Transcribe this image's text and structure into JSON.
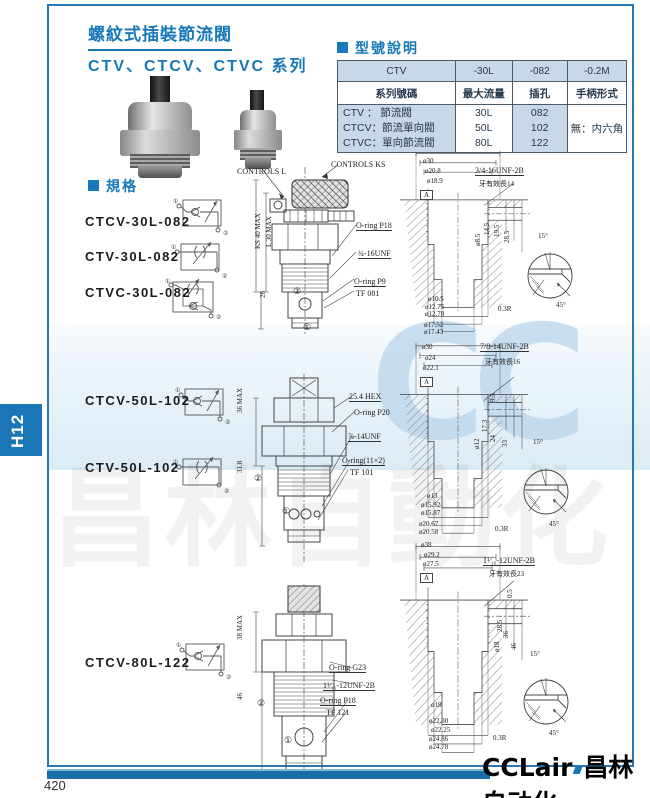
{
  "page": {
    "number": "420",
    "tab": "H12",
    "logo": "CCLair",
    "logo_cn": "昌林自动化"
  },
  "watermark": {
    "cc": "CC",
    "text": "昌林自動化"
  },
  "header": {
    "title": "螺紋式插裝節流閥",
    "subtitle": "CTV、CTCV、CTVC 系列"
  },
  "model_table": {
    "heading": "型號說明",
    "row1": [
      "CTV",
      "-30L",
      "-082",
      "-0.2M"
    ],
    "row2": [
      "系列號碼",
      "最大流量",
      "插孔",
      "手柄形式"
    ],
    "series": [
      "CTV ： 節流閥",
      "CTCV：節流單向閥",
      "CTVC：單向節流閥"
    ],
    "flows": [
      "30L",
      "50L",
      "80L"
    ],
    "holes": [
      "082",
      "102",
      "122"
    ],
    "handle": "無：内六角"
  },
  "spec": {
    "heading": "規格",
    "port1": "①",
    "port2": "②",
    "models": [
      "CTCV-30L-082",
      "CTV-30L-082",
      "CTVC-30L-082",
      "CTCV-50L-102",
      "CTV-50L-102",
      "CTCV-80L-122"
    ]
  },
  "drawings": [
    {
      "name": "30L",
      "valve": {
        "label_left": "CONTROLS L",
        "label_right": "CONTROLS KS",
        "dims": [
          "KS 40 MAX",
          "L 30 MAX",
          "28"
        ],
        "callouts": [
          "O-ring P18",
          "¾-16UNF",
          "O-ring P9",
          "TF 081"
        ],
        "ports": [
          "②",
          "①"
        ]
      },
      "cavity": {
        "top_dias": [
          "ø30",
          "ø20.8",
          "ø18.9"
        ],
        "datum": "A",
        "thread": "3/4-16UNF-2B",
        "thread_note": "牙有效長14",
        "depths": [
          "14.5",
          "19.5",
          "28.5"
        ],
        "port_dia": "ø8.5",
        "bottom_dias": [
          "ø10.5",
          "ø12.75",
          "ø12.70",
          "ø17.52",
          "ø17.43"
        ]
      },
      "detail": {
        "angle1": "15°",
        "radius": "0.3R",
        "angle2": "45°"
      }
    },
    {
      "name": "50L",
      "valve": {
        "dims": [
          "36 MAX",
          "31.8"
        ],
        "callouts": [
          "25.4 HEX",
          "O-ring P20",
          "⅞-14UNF",
          "O-ring(11×2)",
          "TF 101"
        ],
        "ports": [
          "②",
          "①"
        ]
      },
      "cavity": {
        "top_dias": [
          "ø30",
          "ø24",
          "ø22.1"
        ],
        "datum": "A",
        "thread": "7/8-14UNF-2B",
        "thread_note": "牙有效長16",
        "depths": [
          "9.5",
          "17.3",
          "24",
          "33"
        ],
        "port_dia": "ø12",
        "bottom_dias": [
          "ø13",
          "ø15.92",
          "ø15.87",
          "ø20.67",
          "ø20.58"
        ]
      },
      "detail": {
        "angle1": "15°",
        "radius": "0.3R",
        "angle2": "45°"
      }
    },
    {
      "name": "80L",
      "valve": {
        "dims": [
          "38 MAX",
          "46"
        ],
        "callouts": [
          "O-ring G23",
          "1¹⁄₁₆-12UNF-2B",
          "O-ring P18",
          "TF 121"
        ],
        "ports": [
          "②",
          "①"
        ]
      },
      "cavity": {
        "top_dias": [
          "ø38",
          "ø29.2",
          "ø27.5"
        ],
        "datum": "A",
        "thread": "1¹⁄₁₆-12UNF-2B",
        "thread_note": "牙有效長23",
        "depths": [
          "0.5",
          "28.5",
          "36",
          "46"
        ],
        "port_dia": "ø18",
        "bottom_dias": [
          "ø18",
          "ø22.30",
          "ø22.25",
          "ø24.86",
          "ø24.78"
        ]
      },
      "detail": {
        "angle1": "15°",
        "radius": "0.3R",
        "angle2": "45°"
      }
    }
  ]
}
